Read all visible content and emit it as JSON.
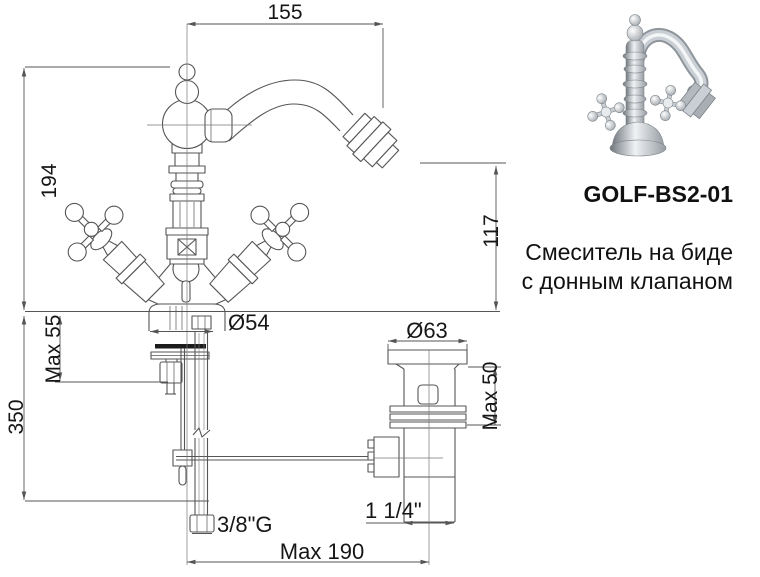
{
  "product": {
    "code": "GOLF-BS2-01",
    "description_line1": "Смеситель на биде",
    "description_line2": "с донным клапаном"
  },
  "drawing": {
    "dimensions": {
      "spout_reach": "155",
      "total_height": "194",
      "spout_height": "117",
      "base_diameter": "Ø54",
      "max_deck": "Max 55",
      "supply_length": "350",
      "flange_diameter": "Ø63",
      "max_valve_body": "Max 50",
      "supply_thread": "3/8\"G",
      "drain_thread": "1 1/4\"",
      "rod_reach": "Max 190"
    },
    "line_color": "#555555",
    "text_color": "#161616",
    "gasket_color": "#1c1c1c"
  }
}
